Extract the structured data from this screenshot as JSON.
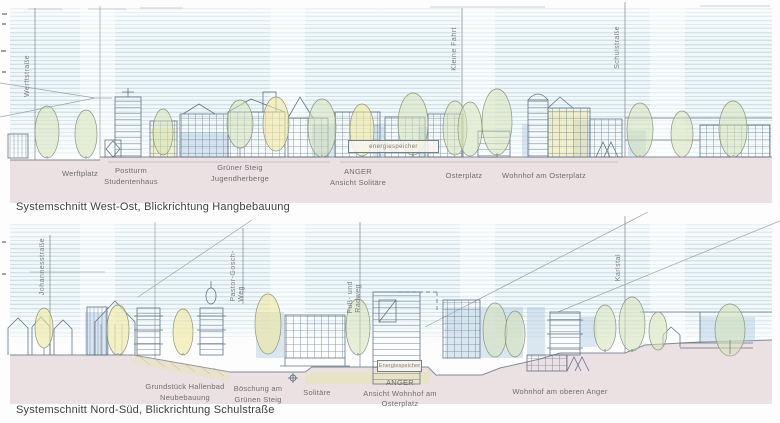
{
  "panel_west_ost": {
    "caption": "Systemschnitt West-Ost, Blickrichtung Hangbebauung",
    "street_labels": {
      "werftstrasse": "Werftstraße",
      "kleine_fahrt": "Kleine Fahrt",
      "schulstrasse": "Schulstraße"
    },
    "area_labels": {
      "werftplatz": "Werftplatz",
      "postturm_line1": "Postturm",
      "postturm_line2": "Studentenhaus",
      "gruener_steig_line1": "Grüner Steig",
      "gruener_steig_line2": "Jugendherberge",
      "anger_line1": "ANGER",
      "anger_line2": "Ansicht Solitäre",
      "osterplatz": "Osterplatz",
      "wohnhof_am_osterplatz": "Wohnhof am Osterplatz"
    },
    "annotations": {
      "energiespeicher": "energiespeicher"
    }
  },
  "panel_nord_sued": {
    "caption": "Systemschnitt Nord-Süd, Blickrichtung Schulstraße",
    "street_labels": {
      "johannesstrasse": "Johannesstraße",
      "pastor_gosch_line1": "Pastor-Gosch-",
      "pastor_gosch_line2": "Weg",
      "fuss_radweg_line1": "Fuß- und",
      "fuss_radweg_line2": "Radweg",
      "karlstal": "Karlstal"
    },
    "area_labels": {
      "hallenbad_line1": "Grundstück Hallenbad",
      "hallenbad_line2": "Neubebauung",
      "boeschung_line1": "Böschung am",
      "boeschung_line2": "Grünen Steig",
      "solitaere": "Solitäre",
      "anger_line1": "ANGER",
      "anger_line2": "Ansicht Wohnhof am",
      "anger_line3": "Osterplatz",
      "wohnhof_oberer_anger": "Wohnhof am oberen Anger"
    },
    "annotations": {
      "energiespeicher": "Energiespeicher"
    }
  },
  "colors": {
    "sky_hatch": "#8cb6c8",
    "ground_fill": "#ebe1e3",
    "sketch_line": "#51677c",
    "tree_green": "#d6e2b8",
    "tree_yellow": "#f0e79e",
    "shade_blue": "#a6c2db",
    "label_text": "#6e6e6e",
    "caption_text": "#414141"
  }
}
